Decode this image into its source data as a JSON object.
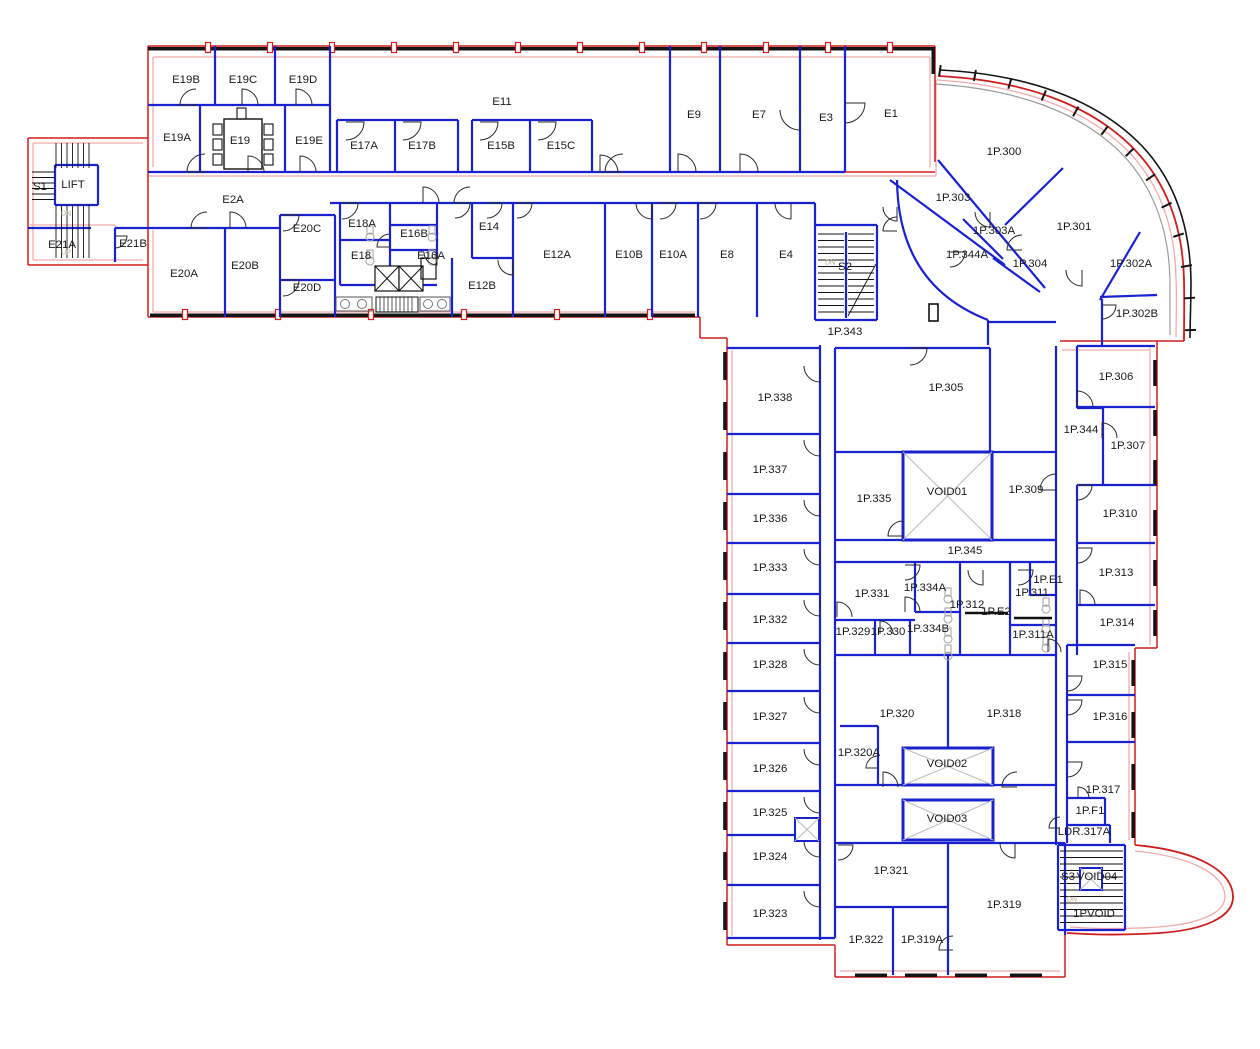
{
  "drawing": {
    "type": "architectural-floor-plan",
    "colors": {
      "exterior_wall": "#cf1d1d",
      "exterior_inner": "#f2abab",
      "interior_wall": "#1a22cf",
      "window_band": "#141414",
      "door_arc": "#2a2a2a",
      "void_cross": "#bcbcbc",
      "facade_gray": "#9c9c9c",
      "fixture": "#a8a8a8",
      "label_text": "#1a1a1a",
      "stair_mark": "#b5a888"
    },
    "rooms": [
      {
        "label": "E19B",
        "x": 186,
        "y": 80
      },
      {
        "label": "E19C",
        "x": 243,
        "y": 80
      },
      {
        "label": "E19D",
        "x": 303,
        "y": 80
      },
      {
        "label": "E19A",
        "x": 177,
        "y": 138
      },
      {
        "label": "E19",
        "x": 240,
        "y": 141
      },
      {
        "label": "E19E",
        "x": 309,
        "y": 141
      },
      {
        "label": "E11",
        "x": 502,
        "y": 102
      },
      {
        "label": "E17A",
        "x": 364,
        "y": 146
      },
      {
        "label": "E17B",
        "x": 422,
        "y": 146
      },
      {
        "label": "E15B",
        "x": 501,
        "y": 146
      },
      {
        "label": "E15C",
        "x": 561,
        "y": 146
      },
      {
        "label": "E9",
        "x": 694,
        "y": 115
      },
      {
        "label": "E7",
        "x": 759,
        "y": 115
      },
      {
        "label": "E3",
        "x": 826,
        "y": 118
      },
      {
        "label": "E1",
        "x": 891,
        "y": 114
      },
      {
        "label": "S1",
        "x": 40,
        "y": 187
      },
      {
        "label": "LIFT",
        "x": 73,
        "y": 185
      },
      {
        "label": "E21A",
        "x": 62,
        "y": 245
      },
      {
        "label": "E21B",
        "x": 133,
        "y": 244
      },
      {
        "label": "E2A",
        "x": 233,
        "y": 200
      },
      {
        "label": "E20A",
        "x": 184,
        "y": 274
      },
      {
        "label": "E20B",
        "x": 245,
        "y": 266
      },
      {
        "label": "E20C",
        "x": 307,
        "y": 229
      },
      {
        "label": "E20D",
        "x": 307,
        "y": 288
      },
      {
        "label": "E18A",
        "x": 362,
        "y": 224
      },
      {
        "label": "E18",
        "x": 361,
        "y": 256
      },
      {
        "label": "E16B",
        "x": 414,
        "y": 234
      },
      {
        "label": "E16A",
        "x": 431,
        "y": 256
      },
      {
        "label": "E14",
        "x": 489,
        "y": 227
      },
      {
        "label": "E12B",
        "x": 482,
        "y": 286
      },
      {
        "label": "E12A",
        "x": 557,
        "y": 255
      },
      {
        "label": "E10B",
        "x": 629,
        "y": 255
      },
      {
        "label": "E10A",
        "x": 673,
        "y": 255
      },
      {
        "label": "E8",
        "x": 727,
        "y": 255
      },
      {
        "label": "E4",
        "x": 786,
        "y": 255
      },
      {
        "label": "S2",
        "x": 845,
        "y": 267
      },
      {
        "label": "1P.300",
        "x": 1004,
        "y": 152
      },
      {
        "label": "1P.303",
        "x": 953,
        "y": 198
      },
      {
        "label": "1P.303A",
        "x": 994,
        "y": 231
      },
      {
        "label": "1P.344A",
        "x": 967,
        "y": 255
      },
      {
        "label": "1P.304",
        "x": 1030,
        "y": 264
      },
      {
        "label": "1P.301",
        "x": 1074,
        "y": 227
      },
      {
        "label": "1P.302A",
        "x": 1131,
        "y": 264
      },
      {
        "label": "1P.302B",
        "x": 1137,
        "y": 314
      },
      {
        "label": "1P.343",
        "x": 845,
        "y": 332
      },
      {
        "label": "1P.338",
        "x": 775,
        "y": 398
      },
      {
        "label": "1P.337",
        "x": 770,
        "y": 470
      },
      {
        "label": "1P.336",
        "x": 770,
        "y": 519
      },
      {
        "label": "1P.333",
        "x": 770,
        "y": 568
      },
      {
        "label": "1P.332",
        "x": 770,
        "y": 620
      },
      {
        "label": "1P.328",
        "x": 770,
        "y": 665
      },
      {
        "label": "1P.327",
        "x": 770,
        "y": 717
      },
      {
        "label": "1P.326",
        "x": 770,
        "y": 769
      },
      {
        "label": "1P.325",
        "x": 770,
        "y": 813
      },
      {
        "label": "1P.324",
        "x": 770,
        "y": 857
      },
      {
        "label": "1P.323",
        "x": 770,
        "y": 914
      },
      {
        "label": "1P.305",
        "x": 946,
        "y": 388
      },
      {
        "label": "1P.335",
        "x": 874,
        "y": 499
      },
      {
        "label": "VOID01",
        "x": 947,
        "y": 492
      },
      {
        "label": "1P.309",
        "x": 1026,
        "y": 490
      },
      {
        "label": "1P.344",
        "x": 1081,
        "y": 430
      },
      {
        "label": "1P.306",
        "x": 1116,
        "y": 377
      },
      {
        "label": "1P.307",
        "x": 1128,
        "y": 446
      },
      {
        "label": "1P.310",
        "x": 1120,
        "y": 514
      },
      {
        "label": "1P.345",
        "x": 965,
        "y": 551
      },
      {
        "label": "1P.331",
        "x": 872,
        "y": 594
      },
      {
        "label": "1P.334A",
        "x": 925,
        "y": 588
      },
      {
        "label": "1P.329",
        "x": 853,
        "y": 632
      },
      {
        "label": "1P.330",
        "x": 888,
        "y": 632
      },
      {
        "label": "1P.334B",
        "x": 928,
        "y": 629
      },
      {
        "label": "1P.312",
        "x": 967,
        "y": 605
      },
      {
        "label": "1P.E2",
        "x": 996,
        "y": 612
      },
      {
        "label": "1P.311",
        "x": 1032,
        "y": 593
      },
      {
        "label": "1P.E1",
        "x": 1048,
        "y": 580
      },
      {
        "label": "1P.311A",
        "x": 1033,
        "y": 635
      },
      {
        "label": "1P.313",
        "x": 1116,
        "y": 573
      },
      {
        "label": "1P.314",
        "x": 1117,
        "y": 623
      },
      {
        "label": "1P.320",
        "x": 897,
        "y": 714
      },
      {
        "label": "1P.318",
        "x": 1004,
        "y": 714
      },
      {
        "label": "1P.320A",
        "x": 859,
        "y": 753
      },
      {
        "label": "VOID02",
        "x": 947,
        "y": 764
      },
      {
        "label": "1P.315",
        "x": 1110,
        "y": 665
      },
      {
        "label": "1P.316",
        "x": 1110,
        "y": 717
      },
      {
        "label": "1P.317",
        "x": 1103,
        "y": 790
      },
      {
        "label": "1P.F1",
        "x": 1090,
        "y": 811
      },
      {
        "label": "LDR.317A",
        "x": 1084,
        "y": 832
      },
      {
        "label": "VOID03",
        "x": 947,
        "y": 819
      },
      {
        "label": "1P.321",
        "x": 891,
        "y": 871
      },
      {
        "label": "1P.319",
        "x": 1004,
        "y": 905
      },
      {
        "label": "S3",
        "x": 1068,
        "y": 877
      },
      {
        "label": "VOID04",
        "x": 1097,
        "y": 877
      },
      {
        "label": "1PVOID",
        "x": 1094,
        "y": 914
      },
      {
        "label": "1P.322",
        "x": 866,
        "y": 940
      },
      {
        "label": "1P.319A",
        "x": 922,
        "y": 940
      }
    ],
    "stair_marks": [
      {
        "label": "DN",
        "x": 66,
        "y": 214
      },
      {
        "label": "UP",
        "x": 66,
        "y": 253
      },
      {
        "label": "DN",
        "x": 830,
        "y": 263
      },
      {
        "label": "DN",
        "x": 1072,
        "y": 900
      }
    ]
  }
}
